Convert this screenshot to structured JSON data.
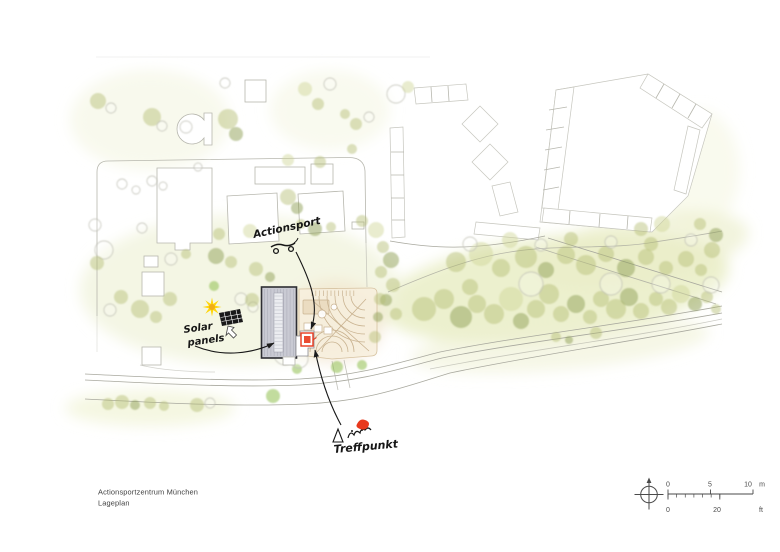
{
  "title_block": {
    "project_name": "Actionsportzentrum München",
    "drawing_name": "Lageplan"
  },
  "scale_bar": {
    "meters_ticks": [
      "0",
      "5",
      "10"
    ],
    "meters_unit": "m",
    "feet_ticks": [
      "0",
      "20"
    ],
    "feet_unit": "ft"
  },
  "annotations": {
    "actionsport_label": "Actionsport",
    "solar_label_line1": "Solar",
    "solar_label_line2": "panels",
    "treffpunkt_label": "Treffpunkt"
  },
  "icons": {
    "north_arrow": "compass-crosshair-icon",
    "sun": "sun-sketch-icon",
    "solar_panel": "solar-panel-sketch-icon",
    "skateboard": "skateboard-sketch-icon",
    "meeting_people": "people-meeting-sketch-icon",
    "heart": "red-heart-blob-icon"
  },
  "colors": {
    "tree_olive": "#b3bd72",
    "tree_dark": "#8fa055",
    "tree_bright": "#8fc04f",
    "wash_green": "#e6ebbd",
    "building_fill": "#c9cad3",
    "building_outline": "#2e2e33",
    "skatepark_beige": "#f7eedd",
    "skatepark_line": "#c9b391",
    "accent_red": "#e8391d",
    "sun_yellow": "#ffd60a",
    "line_gray": "#a8a89e",
    "text_gray": "#3f3f3f"
  }
}
